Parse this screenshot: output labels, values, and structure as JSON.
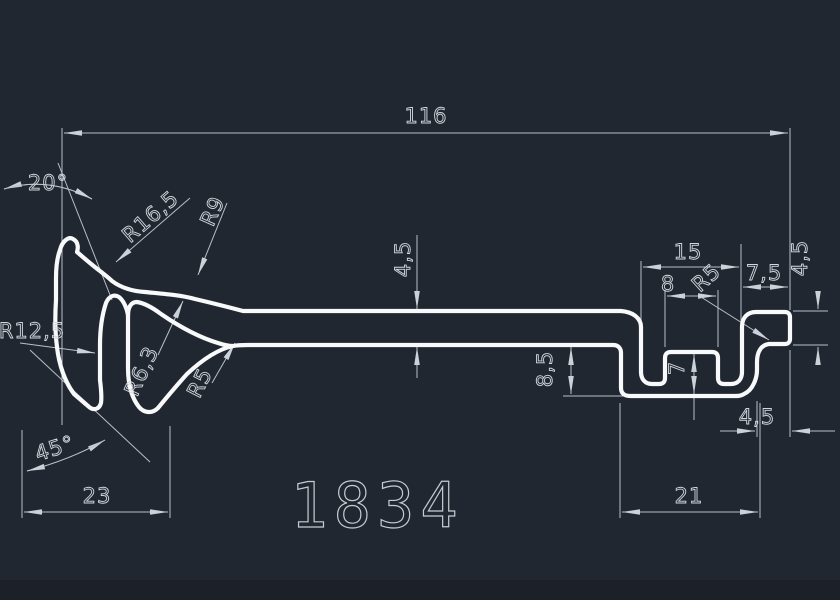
{
  "drawing": {
    "part_number": "1834",
    "colors": {
      "background": "#212731",
      "profile_line": "#f7f9fa",
      "dimension_line": "#b9bfc7",
      "text": "#d2d7dd"
    },
    "dimensions": {
      "total_width": "116",
      "left_hook_width": "23",
      "channel_outer_width": "21",
      "slot_opening_width": "15",
      "tab_width": "8",
      "right_flange_offset": "7,5",
      "tab_height": "7",
      "step_depth": "8,5",
      "strip_thickness": "4,5",
      "right_flange_height": "4,5",
      "right_flange_overhang": "4,5",
      "top_angle": "20°",
      "bottom_angle": "45°"
    },
    "radii": {
      "arm_outer": "R16,5",
      "crest": "R9",
      "claw_inner": "R12,5",
      "valley": "R6,3",
      "left_fillet": "R5",
      "right_fillet": "R5"
    }
  }
}
